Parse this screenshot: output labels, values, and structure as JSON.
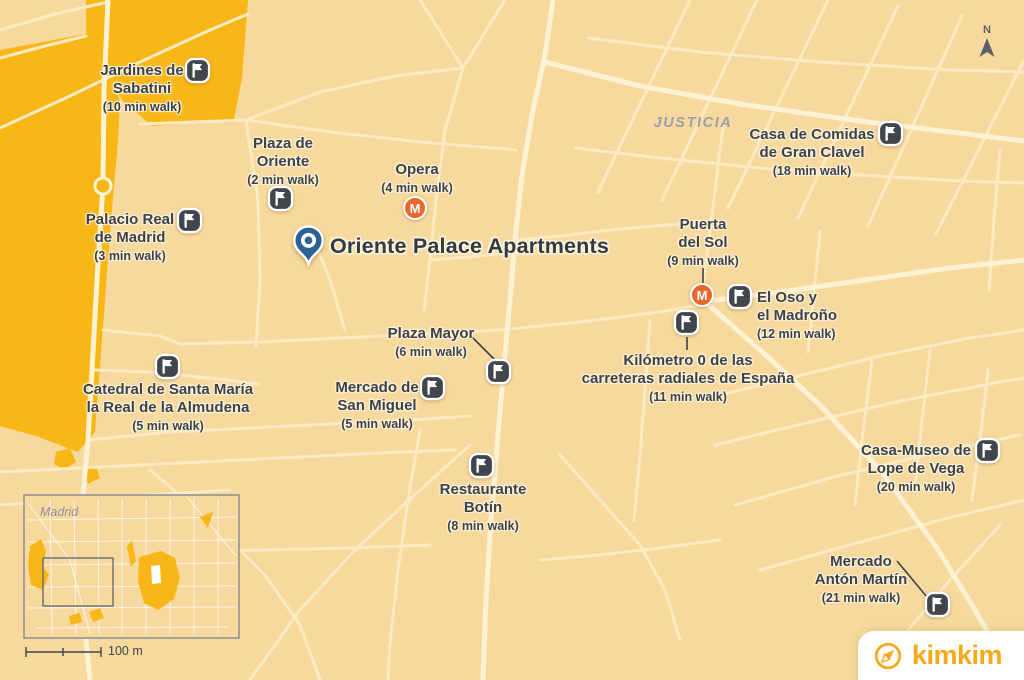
{
  "map": {
    "place_title": "Oriente Palace Apartments",
    "neighborhood": "JUSTICIA",
    "metro_letter": "M",
    "north_label": "N",
    "inset": {
      "city": "Madrid",
      "scale": "100 m"
    },
    "brand": "kimkim",
    "colors": {
      "background": "#f7d99e",
      "road_minor": "#fbeac2",
      "road_major": "#fdf2d3",
      "park": "#f8b717",
      "pin_blue": "#2c6292",
      "metro_orange": "#e8682d",
      "flag_dark": "#41464d",
      "label_text": "#3c414a",
      "muted_gray": "#9aa0aa",
      "brand_orange": "#f9a81b"
    }
  },
  "pois": [
    {
      "id": "jardines-de-sabatini",
      "line1": "Jardines de",
      "line2": "Sabatini",
      "walk": "(10 min walk)"
    },
    {
      "id": "plaza-de-oriente",
      "line1": "Plaza de",
      "line2": "Oriente",
      "walk": "(2 min walk)"
    },
    {
      "id": "opera",
      "line1": "Opera",
      "line2": "",
      "walk": "(4 min walk)"
    },
    {
      "id": "palacio-real-de-madrid",
      "line1": "Palacio Real",
      "line2": "de Madrid",
      "walk": "(3 min walk)"
    },
    {
      "id": "casa-de-comidas-de-gran-clavel",
      "line1": "Casa de Comidas",
      "line2": "de Gran Clavel",
      "walk": "(18 min walk)"
    },
    {
      "id": "puerta-del-sol",
      "line1": "Puerta",
      "line2": "del Sol",
      "walk": "(9 min walk)"
    },
    {
      "id": "el-oso-y-el-madrono",
      "line1": "El Oso y",
      "line2": "el Madroño",
      "walk": "(12 min walk)"
    },
    {
      "id": "kilometro-0",
      "line1": "Kilómetro 0 de las",
      "line2": "carreteras radiales de España",
      "walk": "(11 min walk)"
    },
    {
      "id": "plaza-mayor",
      "line1": "Plaza Mayor",
      "line2": "",
      "walk": "(6 min walk)"
    },
    {
      "id": "mercado-de-san-miguel",
      "line1": "Mercado de",
      "line2": "San Miguel",
      "walk": "(5 min walk)"
    },
    {
      "id": "catedral-almudena",
      "line1": "Catedral de Santa María",
      "line2": "la Real de la Almudena",
      "walk": "(5 min walk)"
    },
    {
      "id": "restaurante-botin",
      "line1": "Restaurante",
      "line2": "Botín",
      "walk": "(8 min walk)"
    },
    {
      "id": "casa-museo-lope-de-vega",
      "line1": "Casa-Museo de",
      "line2": "Lope de Vega",
      "walk": "(20 min walk)"
    },
    {
      "id": "mercado-anton-martin",
      "line1": "Mercado",
      "line2": "Antón Martín",
      "walk": "(21 min walk)"
    }
  ]
}
